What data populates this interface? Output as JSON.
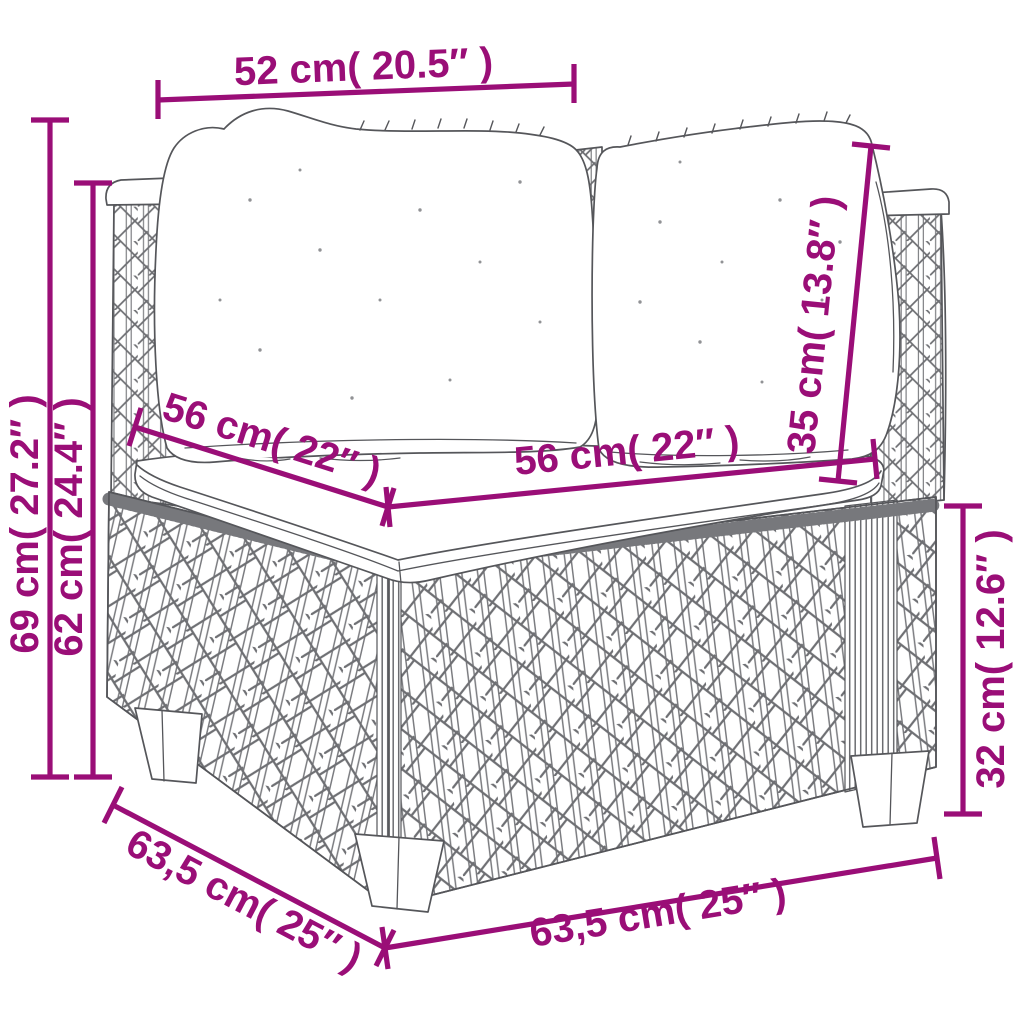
{
  "diagram": {
    "kind": "product-dimension-line-drawing",
    "subject": "poly-rattan corner sofa section with cushions",
    "accent_color": "#9A0E77",
    "sketch_color": "#55565A",
    "dimensions": {
      "top_width": {
        "label": "52 cm( 20.5″ )",
        "meaning": "back cushion width"
      },
      "overall_height": {
        "label": "69 cm( 27.2″ )",
        "meaning": "total height"
      },
      "arm_height": {
        "label": "62 cm( 24.4″ )",
        "meaning": "height to arm/back panel top"
      },
      "seat_depth": {
        "label": "56 cm( 22″ )",
        "meaning": "seat cushion depth"
      },
      "seat_width": {
        "label": "56 cm( 22″ )",
        "meaning": "seat cushion width"
      },
      "back_cushion_height": {
        "label": "35 cm( 13.8″ )",
        "meaning": "back cushion height"
      },
      "base_height": {
        "label": "32 cm( 12.6″ )",
        "meaning": "base box height"
      },
      "side_depth": {
        "label": "63,5 cm( 25″ )",
        "meaning": "overall depth"
      },
      "front_width": {
        "label": "63,5 cm( 25″ )",
        "meaning": "overall width"
      }
    }
  }
}
